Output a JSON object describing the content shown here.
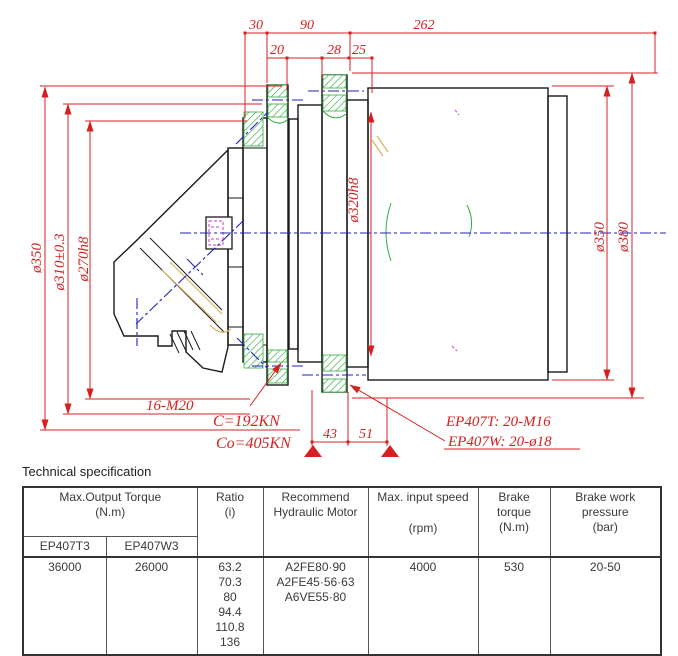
{
  "drawing": {
    "top_dims": {
      "d30": "30",
      "d90": "90",
      "d262": "262",
      "d20": "20",
      "d28": "28",
      "d25": "25"
    },
    "bottom_dims": {
      "d43": "43",
      "d51": "51"
    },
    "left_dims": {
      "outer": "ø350",
      "middle": "ø310±0.3",
      "inner": "ø270h8"
    },
    "right_dims": {
      "pilot": "ø320h8",
      "body": "ø350",
      "flange": "ø380"
    },
    "notes": {
      "bolts_left": "16-M20",
      "load_dynamic": "C=192KN",
      "load_static": "Co=405KN",
      "ep407t_bolts": "EP407T:  20-M16",
      "ep407w_bolts": "EP407W:  20-ø18"
    },
    "colors": {
      "dimension_red": "#d42020",
      "outline_black": "#1a1a1a",
      "centerline_blue": "#2020bb",
      "hatch_green": "#2fae3e",
      "detail_tan": "#d9b35e",
      "detail_magenta": "#c240c2"
    }
  },
  "section_title": "Technical specification",
  "table": {
    "header": {
      "torque_title": "Max.Output Torque",
      "torque_unit": "(N.m)",
      "torque_sub_t3": "EP407T3",
      "torque_sub_w3": "EP407W3",
      "ratio_line1": "Ratio",
      "ratio_line2": "(i)",
      "motor_line1": "Recommend",
      "motor_line2": "Hydraulic Motor",
      "speed_line1": "Max. input speed",
      "speed_line2": "(rpm)",
      "brake_line1": "Brake torque",
      "brake_line2": "(N.m)",
      "pressure_line1": "Brake work",
      "pressure_line2": "pressure",
      "pressure_line3": "(bar)"
    },
    "body": {
      "torque_t3": "36000",
      "torque_w3": "26000",
      "ratios": [
        "63.2",
        "70.3",
        "80",
        "94.4",
        "110.8",
        "136"
      ],
      "motors": [
        "A2FE80·90",
        "A2FE45·56·63",
        "A6VE55·80"
      ],
      "speed": "4000",
      "brake_torque": "530",
      "pressure": "20-50"
    }
  }
}
